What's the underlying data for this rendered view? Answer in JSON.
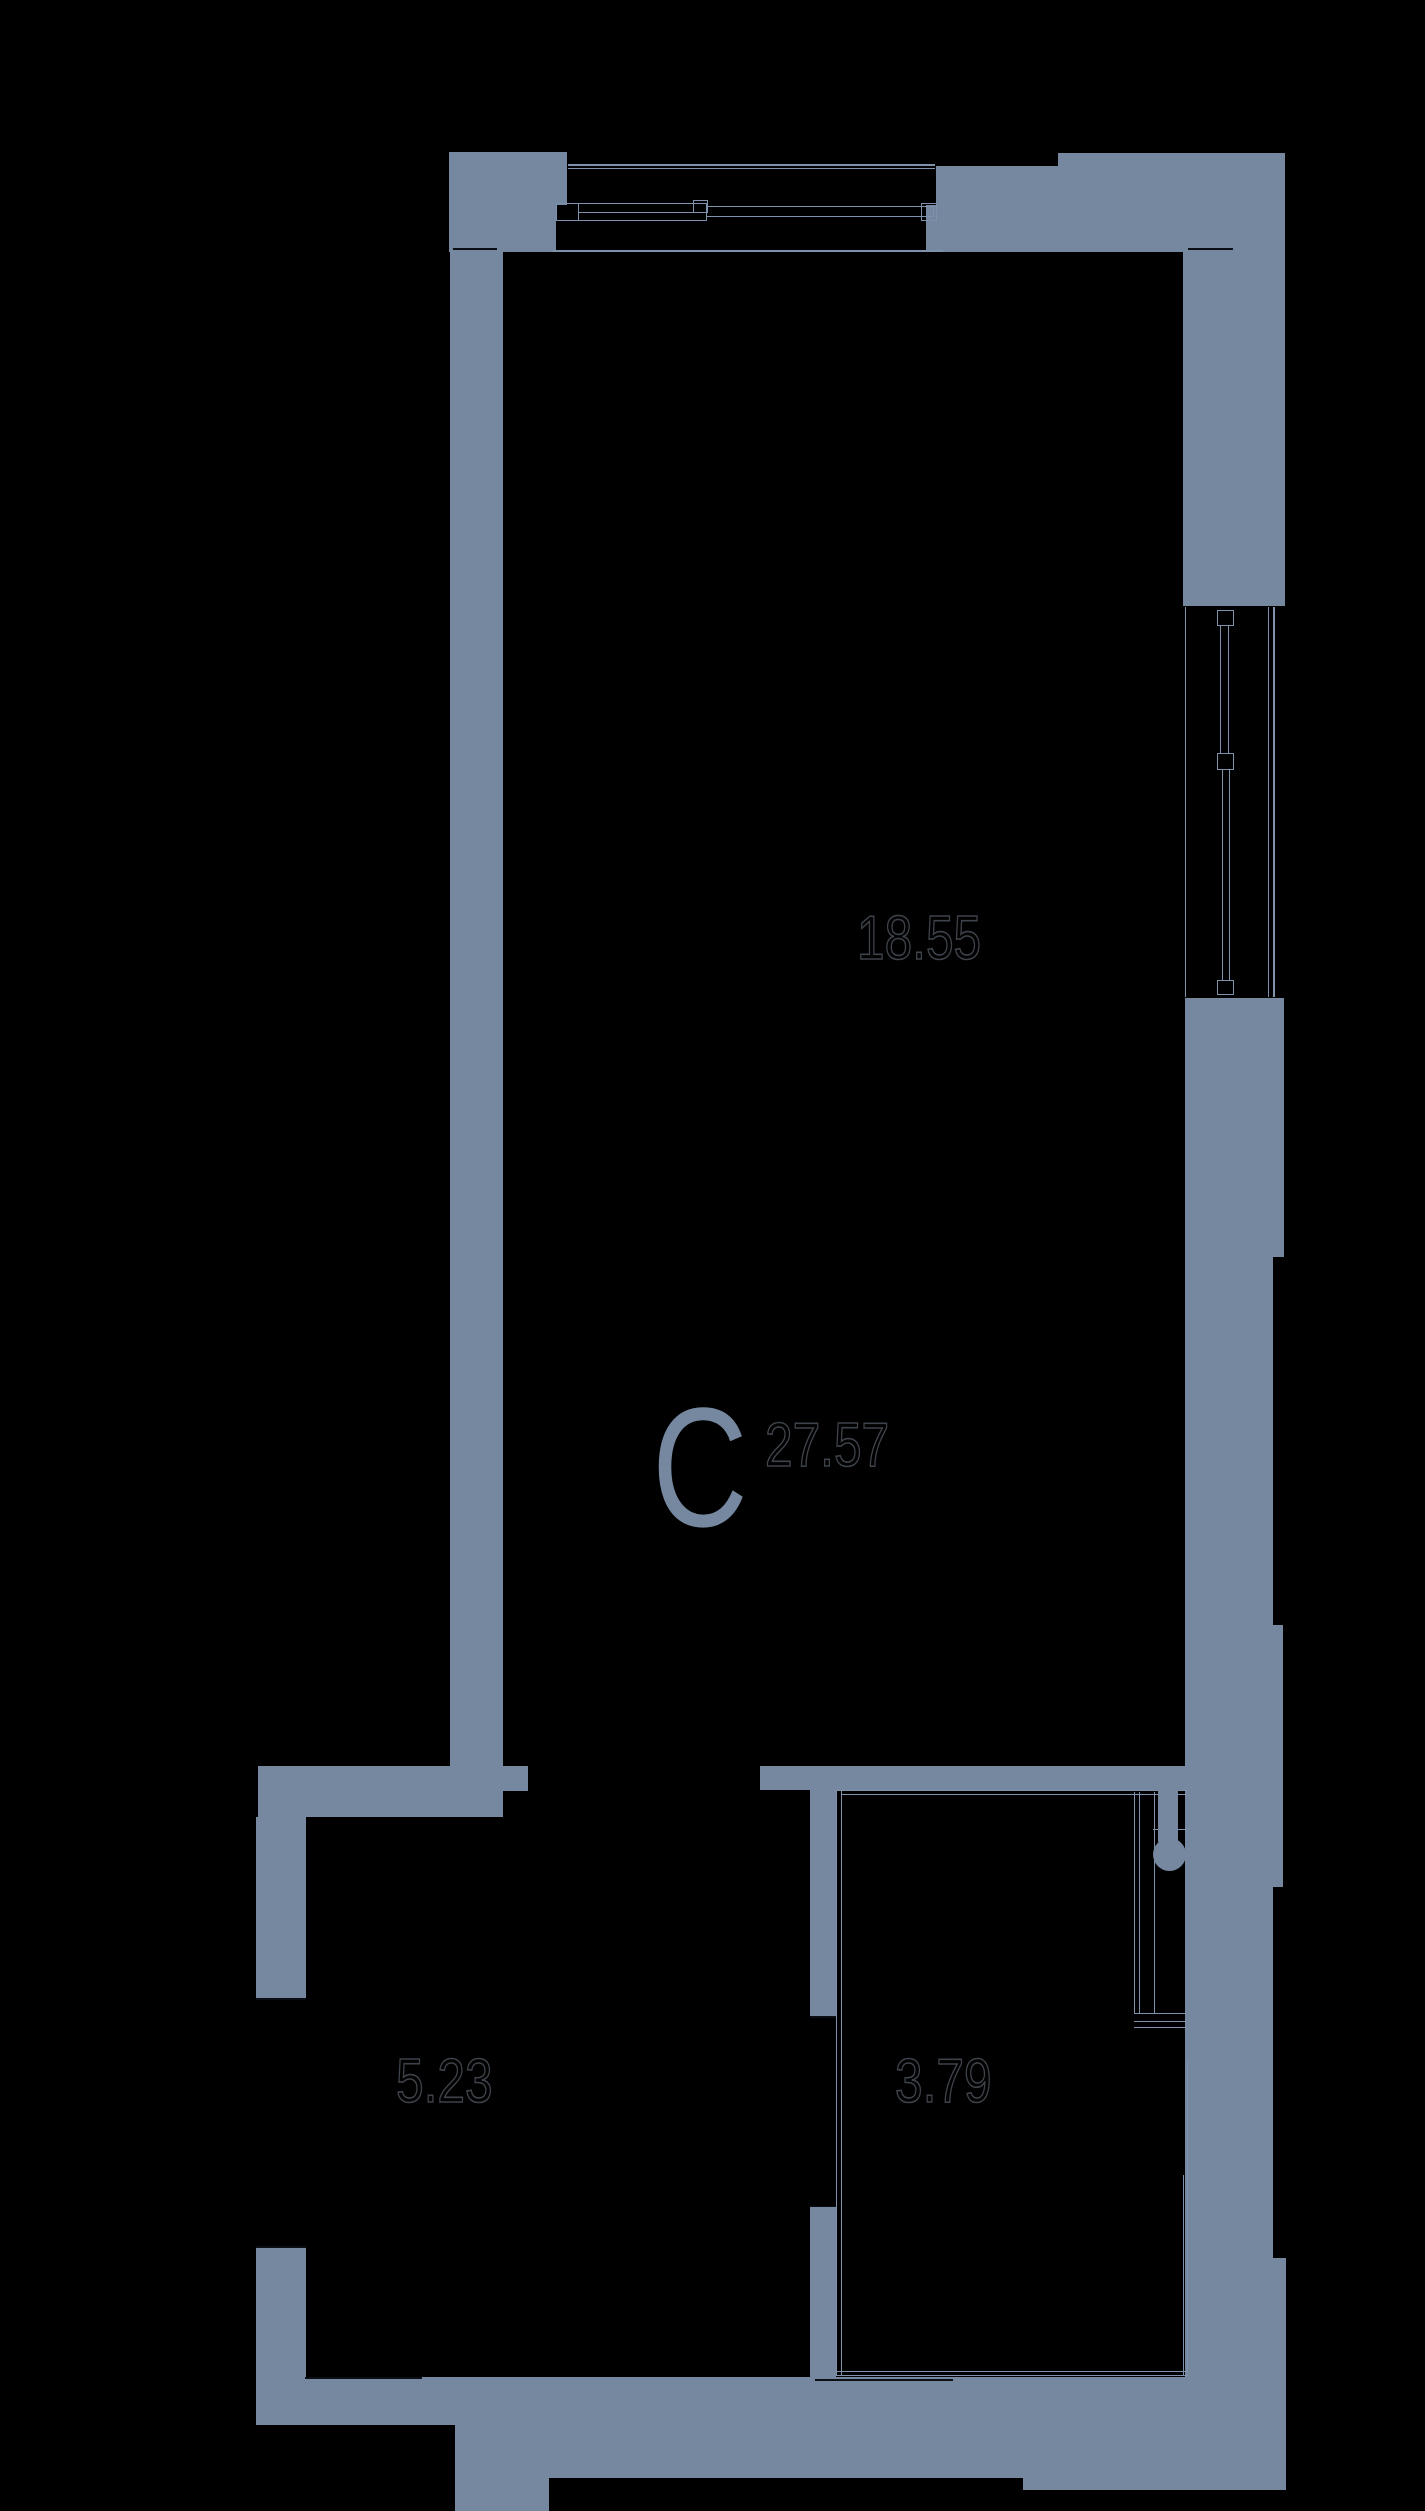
{
  "page": {
    "kind": "apartment floor plan",
    "background": "#000000"
  },
  "palette": {
    "wall": "#7588A0",
    "thin_line": "#7E92AD",
    "joint_cap": "#0B0E13",
    "digit_outline": "#3E434B"
  },
  "plan": {
    "section_letter": "C",
    "rooms": [
      {
        "name": "upper-zone",
        "area": "18.55"
      },
      {
        "name": "main-studio",
        "area": "27.57"
      },
      {
        "name": "hallway",
        "area": "5.23"
      },
      {
        "name": "bathroom",
        "area": "3.79"
      }
    ]
  }
}
